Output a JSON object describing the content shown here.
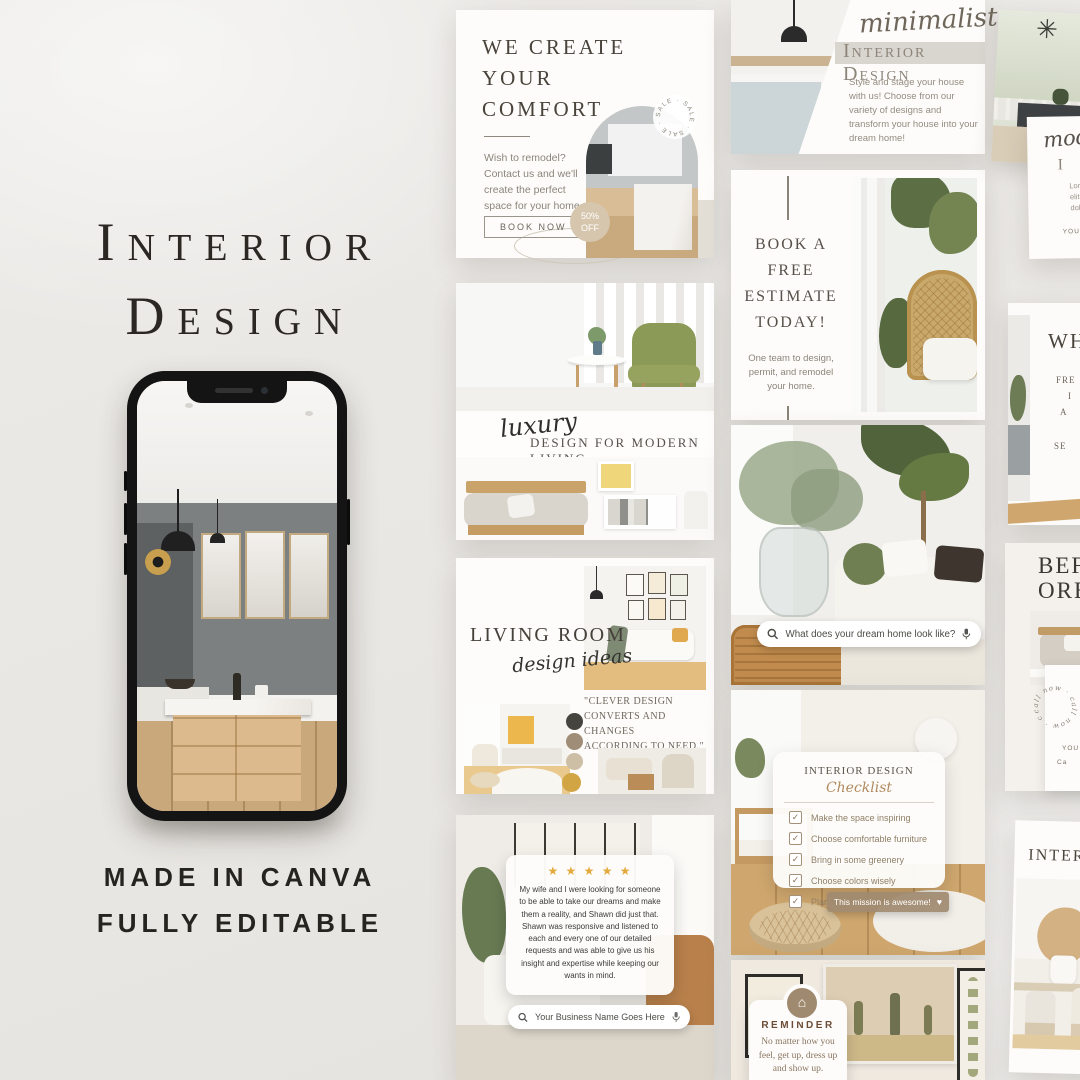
{
  "icons": {
    "check": "✓",
    "heart": "♥",
    "house": "⌂",
    "burst": "✳"
  },
  "left": {
    "title1": "Interior",
    "title2": "Design",
    "made": "MADE IN CANVA",
    "editable": "FULLY EDITABLE"
  },
  "weCreate": {
    "h1": "WE CREATE",
    "h2": "YOUR",
    "h3": "COMFORT",
    "body": "Wish to remodel? Contact us and we'll create the perfect space for your home.",
    "button": "BOOK NOW",
    "sale": "SALE · SALE · SALE · SALE ·",
    "off1": "50%",
    "off2": "OFF"
  },
  "minimalist": {
    "script": "minimalist",
    "head": "Interior Design",
    "body": "Style and stage your house with us! Choose from our variety of designs and transform your house into your dream home!"
  },
  "estimate": {
    "h1": "BOOK A",
    "h2": "FREE",
    "h3": "ESTIMATE",
    "h4": "TODAY!",
    "body": "One team to design, permit, and remodel your home."
  },
  "luxury": {
    "script": "luxury",
    "head": "DESIGN FOR MODERN LIVING"
  },
  "dreamSearch": {
    "query": "What does your dream home look like?"
  },
  "livingRoom": {
    "head": "LIVING ROOM",
    "script": "design ideas",
    "q1": "\"CLEVER DESIGN",
    "q2": "CONVERTS AND CHANGES",
    "q3": "ACCORDING TO NEED.\""
  },
  "checklist": {
    "head": "INTERIOR DESIGN",
    "script": "Checklist",
    "items": [
      "Make the space inspiring",
      "Choose comfortable furniture",
      "Bring in some greenery",
      "Choose colors wisely",
      "Plan for plenty of storage"
    ],
    "button": "This mission is awesome!"
  },
  "review": {
    "stars": "★ ★ ★ ★ ★",
    "body": "My wife and I were looking for someone to be able to take our dreams and make them a reality, and Shawn did just that. Shawn was responsive and listened to each and every one of our detailed requests and was able to give us his insight and expertise while keeping our wants in mind.",
    "query": "Your Business Name Goes Here"
  },
  "reminder": {
    "head": "REMINDER",
    "b1": "No matter how you",
    "b2": "feel, get up, dress up",
    "b3": "and show up."
  },
  "modernCard": {
    "script": "mod",
    "head": "I",
    "b1": "Lorem ipsum",
    "b2": "elit, sed do e",
    "b3": "dolore magn",
    "footer": "YOU"
  },
  "whCard": {
    "head": "WH",
    "l1": "FRE",
    "l2": "I",
    "l3": "A",
    "l4": "SE"
  },
  "beforeCard": {
    "l1": "BEF",
    "l2": "ORE",
    "stamp": "call now · call now · call now ·",
    "f1": "YOU",
    "f2": "Ca"
  },
  "interiorCard": {
    "head": "INTERIOR"
  }
}
